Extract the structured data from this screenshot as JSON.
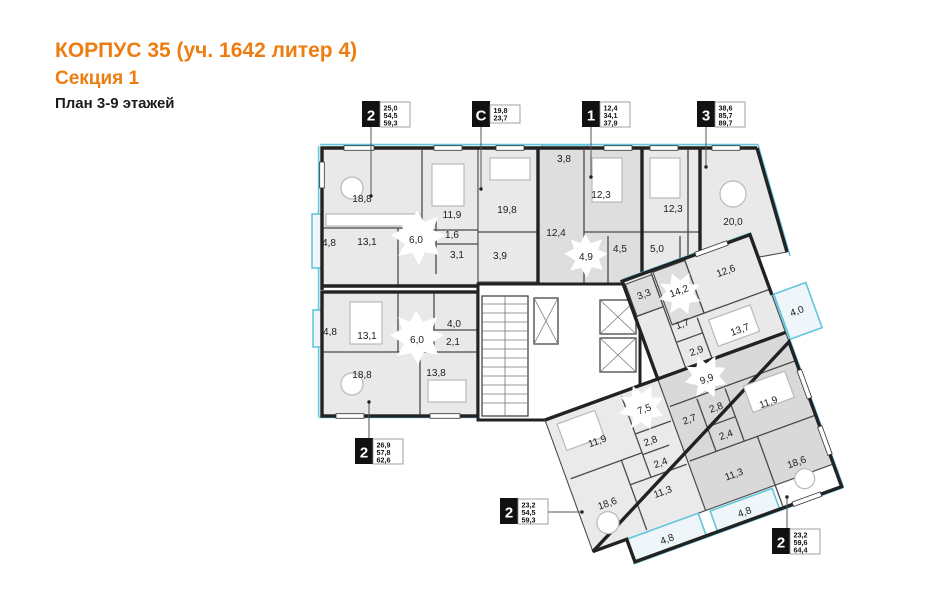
{
  "header": {
    "title": "КОРПУС 35 (уч. 1642 литер 4)",
    "subtitle": "Секция 1",
    "plan": "План 3-9 этажей"
  },
  "colors": {
    "accent_orange": "#ee7d11",
    "facade_cyan": "#63c6dd",
    "wall_dark": "#222222"
  },
  "rooms": {
    "a188": "18,8",
    "a119": "11,9",
    "a131": "13,1",
    "a60": "6,0",
    "a16": "1,6",
    "a31": "3,1",
    "a48": "4,8",
    "c198": "19,8",
    "c39": "3,9",
    "o38": "3,8",
    "o123": "12,3",
    "o124": "12,4",
    "o49": "4,9",
    "o45": "4,5",
    "t123": "12,3",
    "t50": "5,0",
    "t200": "20,0",
    "t33": "3,3",
    "t142": "14,2",
    "t126": "12,6",
    "t137": "13,7",
    "t17": "1,7",
    "t29": "2,9",
    "t40": "4,0",
    "b48": "4,8",
    "b131": "13,1",
    "b60": "6,0",
    "b40": "4,0",
    "b21": "2,1",
    "b188": "18,8",
    "b138": "13,8",
    "w119": "11,9",
    "w75": "7,5",
    "w28": "2,8",
    "w24": "2,4",
    "w186": "18,6",
    "w113": "11,3",
    "w48": "4,8",
    "x99": "9,9",
    "x27": "2,7",
    "x28": "2,8",
    "x24": "2,4",
    "x119": "11,9",
    "x113": "11,3",
    "x186": "18,6",
    "x48": "4,8"
  },
  "badges": [
    {
      "digit": "2",
      "values": [
        "25,0",
        "54,5",
        "59,3"
      ]
    },
    {
      "digit": "С",
      "values": [
        "19,8",
        "23,7"
      ]
    },
    {
      "digit": "1",
      "values": [
        "12,4",
        "34,1",
        "37,9"
      ]
    },
    {
      "digit": "3",
      "values": [
        "38,6",
        "85,7",
        "89,7"
      ]
    },
    {
      "digit": "2",
      "values": [
        "26,9",
        "57,8",
        "62,6"
      ]
    },
    {
      "digit": "2",
      "values": [
        "23,2",
        "54,5",
        "59,3"
      ]
    },
    {
      "digit": "2",
      "values": [
        "23,2",
        "59,6",
        "64,4"
      ]
    }
  ]
}
